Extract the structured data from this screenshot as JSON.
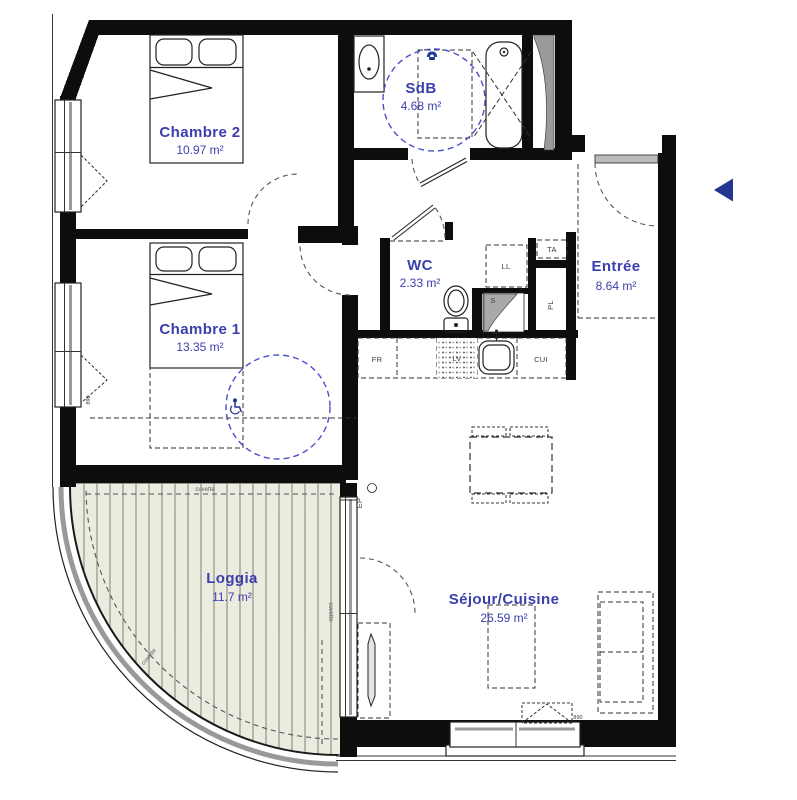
{
  "palette": {
    "accent_blue": "#3a3fae",
    "dash_blue": "#4a50c8",
    "icon_blue": "#23368f",
    "wall_black": "#0d0d0d",
    "deck_fill": "#ecebdf"
  },
  "rooms": {
    "chambre2": {
      "name": "Chambre 2",
      "area": "10.97 m²"
    },
    "sdb": {
      "name": "SdB",
      "area": "4.68 m²"
    },
    "wc": {
      "name": "WC",
      "area": "2.33 m²"
    },
    "entree": {
      "name": "Entrée",
      "area": "8.64 m²"
    },
    "chambre1": {
      "name": "Chambre 1",
      "area": "13.35 m²"
    },
    "sejour": {
      "name": "Séjour/Cuisine",
      "area": "26.59 m²"
    },
    "loggia": {
      "name": "Loggia",
      "area": "11.7 m²"
    }
  },
  "fixtures": {
    "fridge": "FR",
    "dishwasher": "LV",
    "cooker": "CUI",
    "washing_machine": "LL",
    "electrical_board": "TA",
    "closet": "PL",
    "duct": "S",
    "rain_pipe": "EP"
  },
  "annotations": {
    "gutter": "cuvette",
    "door_width": "890"
  }
}
